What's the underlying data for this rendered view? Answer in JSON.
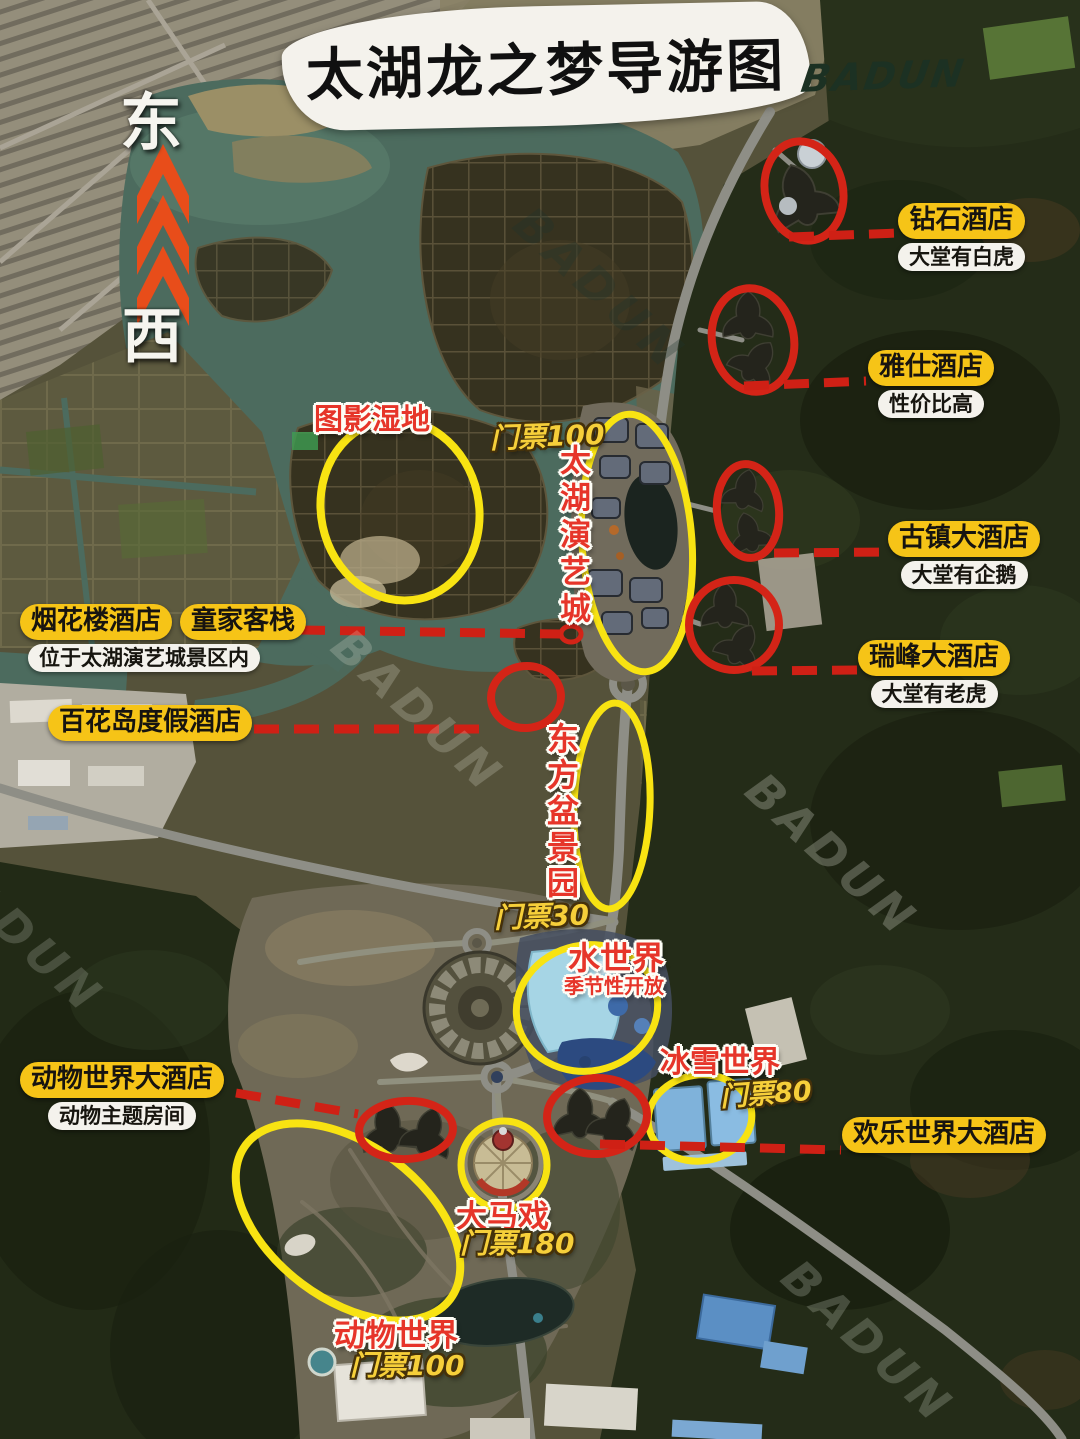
{
  "title": {
    "text": "太湖龙之梦导游图",
    "brand": "BADUN"
  },
  "compass": {
    "east": "东",
    "west": "西"
  },
  "watermark": "BADUN",
  "attractions": [
    {
      "id": "tuying-shidi",
      "name": "图影湿地"
    },
    {
      "id": "taihu-yanyicheng",
      "name": "太湖演艺城",
      "ticket": "门票100"
    },
    {
      "id": "dongfang-penjingyuan",
      "name": "东方盆景园",
      "ticket": "门票30"
    },
    {
      "id": "shui-shijie",
      "name": "水世界",
      "note": "季节性开放"
    },
    {
      "id": "bingxue-shijie",
      "name": "冰雪世界",
      "ticket": "门票80"
    },
    {
      "id": "da-maxi",
      "name": "大马戏",
      "ticket": "门票180"
    },
    {
      "id": "dongwu-shijie",
      "name": "动物世界",
      "ticket": "门票100"
    }
  ],
  "hotels": [
    {
      "id": "zuanshi",
      "name": "钻石酒店",
      "note": "大堂有白虎"
    },
    {
      "id": "yashi",
      "name": "雅仕酒店",
      "note": "性价比高"
    },
    {
      "id": "guzhen",
      "name": "古镇大酒店",
      "note": "大堂有企鹅"
    },
    {
      "id": "ruifeng",
      "name": "瑞峰大酒店",
      "note": "大堂有老虎"
    },
    {
      "id": "yanhualou",
      "name": "烟花楼酒店",
      "name2": "童家客栈",
      "note": "位于太湖演艺城景区内"
    },
    {
      "id": "baihuadao",
      "name": "百花岛度假酒店"
    },
    {
      "id": "dongwu-dajiudian",
      "name": "动物世界大酒店",
      "note": "动物主题房间"
    },
    {
      "id": "huanle-dajiudian",
      "name": "欢乐世界大酒店"
    }
  ],
  "colors": {
    "pill_yellow": "#F6C417",
    "marker_red": "#D42417",
    "marker_yellow": "#F8E312",
    "label_red": "#E63529",
    "ticket_yellow": "#F6CF3A",
    "compass_orange": "#E84D1A",
    "title_ink": "#101010",
    "brand_green": "#1C3123"
  }
}
